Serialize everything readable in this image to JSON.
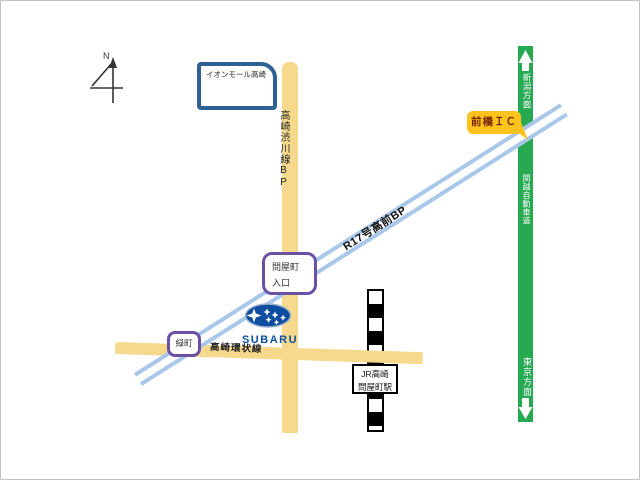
{
  "compass": {
    "north_label": "N"
  },
  "landmarks": {
    "mall": {
      "label": "イオンモール高崎"
    },
    "ic": {
      "label": "前橋ＩＣ"
    },
    "tonyamachi": {
      "line1": "問屋町",
      "line2": "入口"
    },
    "midoricho": {
      "label": "緑町"
    },
    "station": {
      "line1": "JR高崎",
      "line2": "問屋町駅"
    },
    "subaru": {
      "wordmark": "SUBARU"
    }
  },
  "roads": {
    "shibukawa_bp": {
      "label": "高崎渋川線BP"
    },
    "r17_bp": {
      "label": "R17号高前BP"
    },
    "ring_road": {
      "label": "高崎環状線"
    },
    "expressway": {
      "name": "関越自動車道",
      "north_direction": "新潟方面",
      "south_direction": "東京方面"
    }
  },
  "colors": {
    "road_yellow": "#F6D98C",
    "bypass_blue": "#A9C7E8",
    "expressway_green": "#27A952",
    "ic_bg": "#FFC31E",
    "ic_text": "#7B2A00",
    "landmark_purple": "#6B51A5",
    "mall_blue": "#2E6093",
    "subaru_blue": "#0D4FA0"
  }
}
